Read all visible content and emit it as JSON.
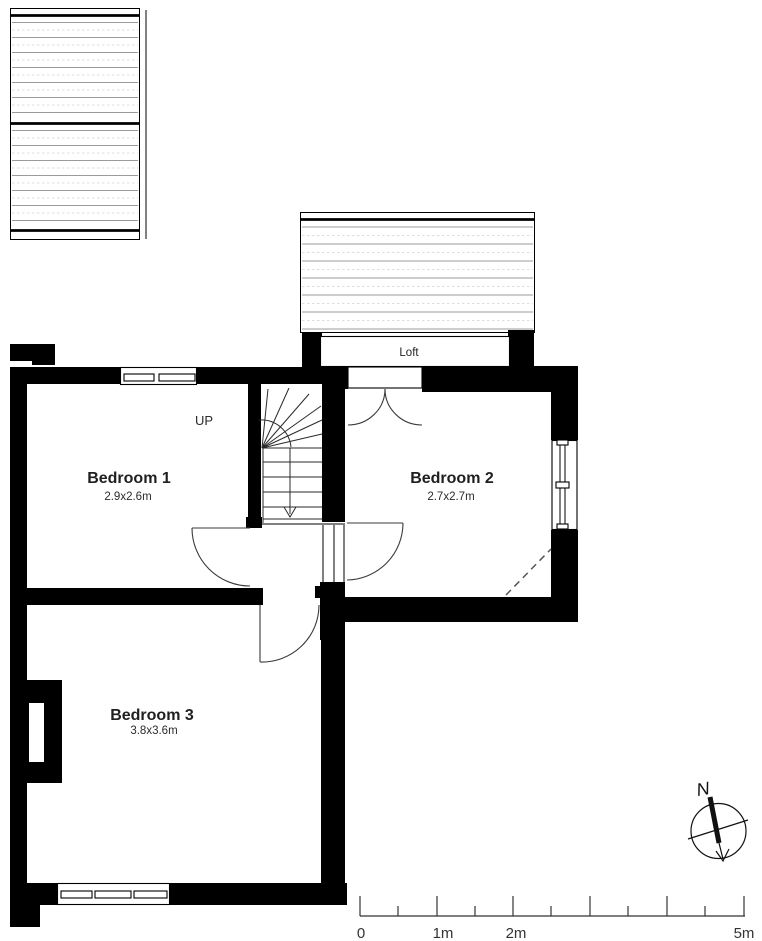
{
  "plan": {
    "type": "first-floor plan",
    "rooms": [
      {
        "name": "Bedroom 1",
        "dimensions": "2.9x2.6m"
      },
      {
        "name": "Bedroom 2",
        "dimensions": "2.7x2.7m"
      },
      {
        "name": "Bedroom 3",
        "dimensions": "3.8x3.6m"
      }
    ],
    "loft_label": "Loft",
    "stairs": {
      "direction_label": "UP"
    },
    "compass": {
      "north_label": "N"
    },
    "scale_bar": {
      "labels": [
        "0",
        "1m",
        "2m",
        "5m"
      ],
      "approx_px_per_m": 77
    },
    "colors": {
      "wall": "#000000",
      "background": "#ffffff",
      "roof_hatch_line": "#9b9b9b",
      "roof_hatch_faint": "#d4d4d4",
      "door_arc": "#3a3a3a",
      "dashed_ceiling_line": "#555555",
      "text": "#1f1f1f"
    }
  }
}
